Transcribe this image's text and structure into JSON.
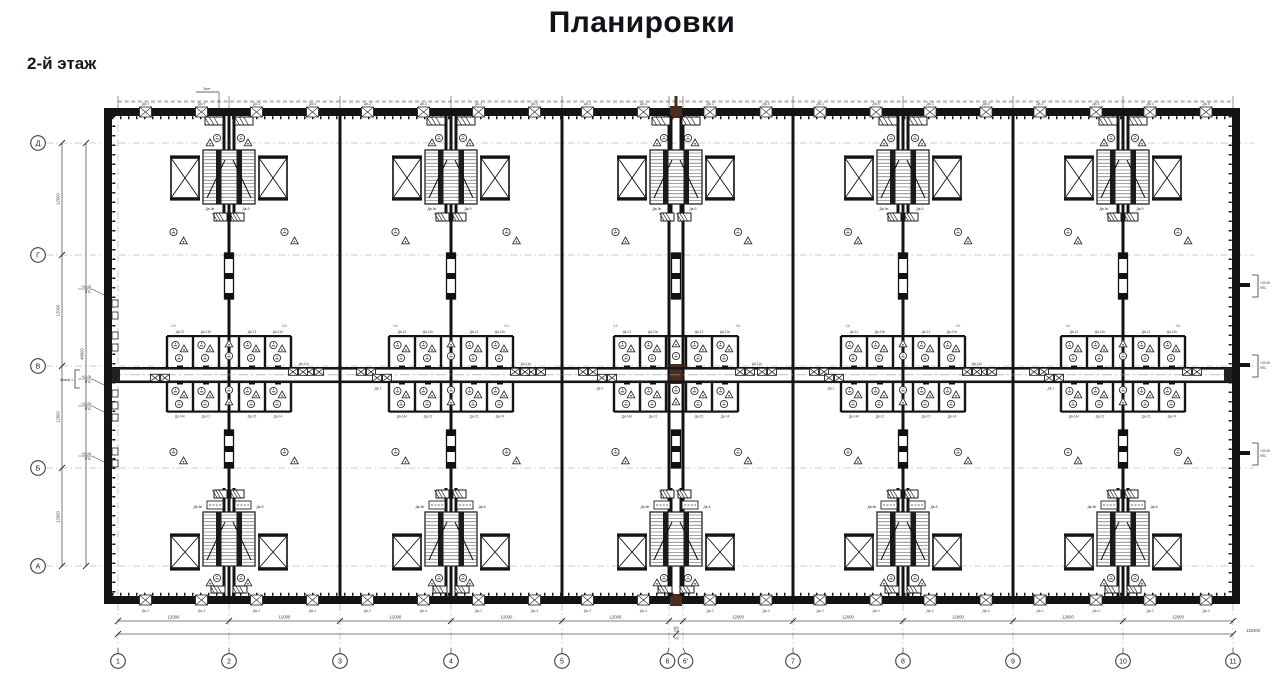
{
  "page": {
    "title": "Планировки",
    "floor_label": "2-й этаж"
  },
  "colors": {
    "wall": "#141414",
    "line": "#333333",
    "thin": "#8d8d8d",
    "axis_line": "#bcbcbc",
    "brown": "#4b2d1d",
    "micro": "#9a9a9a",
    "text": "#1a1a1a"
  },
  "axes": {
    "columns": [
      {
        "label": "1",
        "x": 118
      },
      {
        "label": "2",
        "x": 229
      },
      {
        "label": "3",
        "x": 340
      },
      {
        "label": "4",
        "x": 451
      },
      {
        "label": "5",
        "x": 562
      },
      {
        "label": "6",
        "x": 669
      },
      {
        "label": "6'",
        "x": 683
      },
      {
        "label": "7",
        "x": 793
      },
      {
        "label": "8",
        "x": 903
      },
      {
        "label": "9",
        "x": 1013
      },
      {
        "label": "10",
        "x": 1123
      },
      {
        "label": "11",
        "x": 1233
      }
    ],
    "rows": [
      {
        "label": "Д",
        "y": 143
      },
      {
        "label": "Г",
        "y": 255
      },
      {
        "label": "В",
        "y": 366
      },
      {
        "label": "Б",
        "y": 468
      },
      {
        "label": "А",
        "y": 566
      }
    ]
  },
  "modules": {
    "stair_axes_x": [
      229,
      451,
      676,
      903,
      1123
    ],
    "stair_tags": {
      "top_left": "Дв-9п",
      "top_right": "Дв-9",
      "bottom_left": "Дв-8п",
      "bottom_right": "Дв-8"
    }
  },
  "toilets": {
    "tags_top": [
      "Дв-12",
      "Дв-13п",
      "Дв-13",
      "Дв-12п"
    ],
    "tags_bottom": [
      "Дв-14п",
      "Дв-12",
      "Дв-15",
      "Дв-14"
    ]
  },
  "corridor": {
    "door_axes_x": [
      340,
      562,
      793,
      1013
    ],
    "tag_upper": "Дв-11п",
    "tag_lower": "Дв-1",
    "bay_mark": "2А"
  },
  "perimeter_doors": {
    "tag_a": "Дв-3",
    "tag_b": "Дв-5",
    "tag_bottom_a": "Дв-2",
    "tag_bottom_b": "Дв-4"
  },
  "dimensions": {
    "bay": "12000",
    "joint": "400",
    "joint_half": "700",
    "total_width": "120400",
    "total_height": "48000"
  },
  "annotations": {
    "top_flag": "Зонт",
    "left_bracket": "Зумпф-1",
    "level_mark_line1": "+01,06",
    "level_mark_line2": "9ПС",
    "left_note_ys": [
      295,
      385,
      412,
      462
    ],
    "right_note_ys": [
      283,
      363,
      451
    ]
  }
}
